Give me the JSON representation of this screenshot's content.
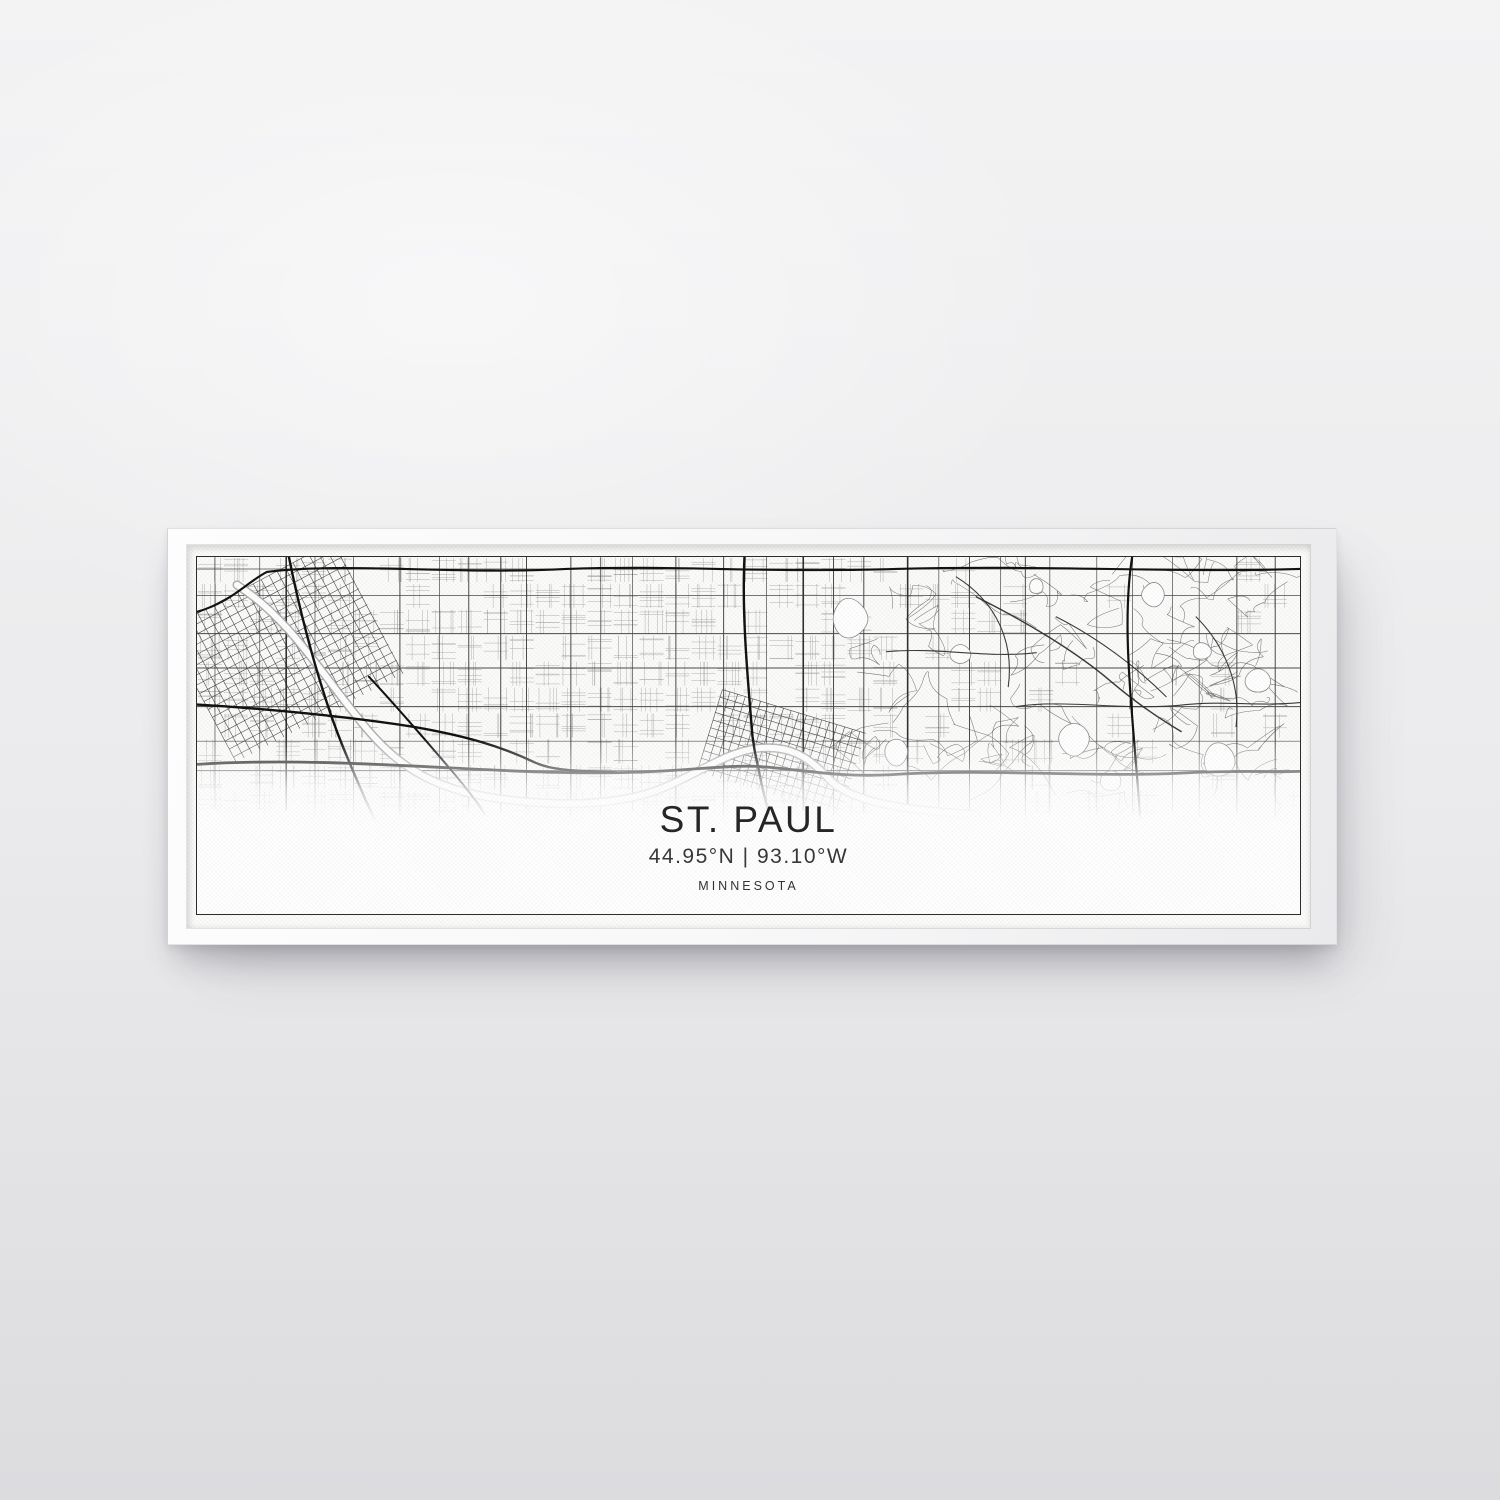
{
  "artwork": {
    "city": "ST. PAUL",
    "coordinates": "44.95°N | 93.10°W",
    "state": "MINNESOTA"
  },
  "scene": {
    "wall_color_top": "#f3f3f4",
    "wall_color_bottom": "#dcdcdf",
    "frame_color": "#eaeaec",
    "canvas_color": "#fbfbfa",
    "border_rule_color": "#2d2d2d",
    "text_color": "#262626"
  },
  "map_render": {
    "seed": 7,
    "width": 1104,
    "height": 358,
    "fade_start": 182,
    "fade_end": 264,
    "colors": {
      "minor": "#9c9c9c",
      "major": "#414141",
      "dark_major": "#262626",
      "freeway": "#121212",
      "connector": "#323232",
      "river_edge": "#ababab",
      "water_fill": "#ffffff",
      "lake_edge": "#8c8c8c",
      "squiggle": "#6d6d6d"
    },
    "downtown_grids": [
      {
        "name": "minneapolis",
        "cx": 88,
        "cy": 95,
        "angle": -28,
        "w": 190,
        "h": 150,
        "spacing": 9
      },
      {
        "name": "st-paul",
        "cx": 585,
        "cy": 196,
        "angle": 17,
        "w": 150,
        "h": 86,
        "spacing": 8
      }
    ]
  }
}
